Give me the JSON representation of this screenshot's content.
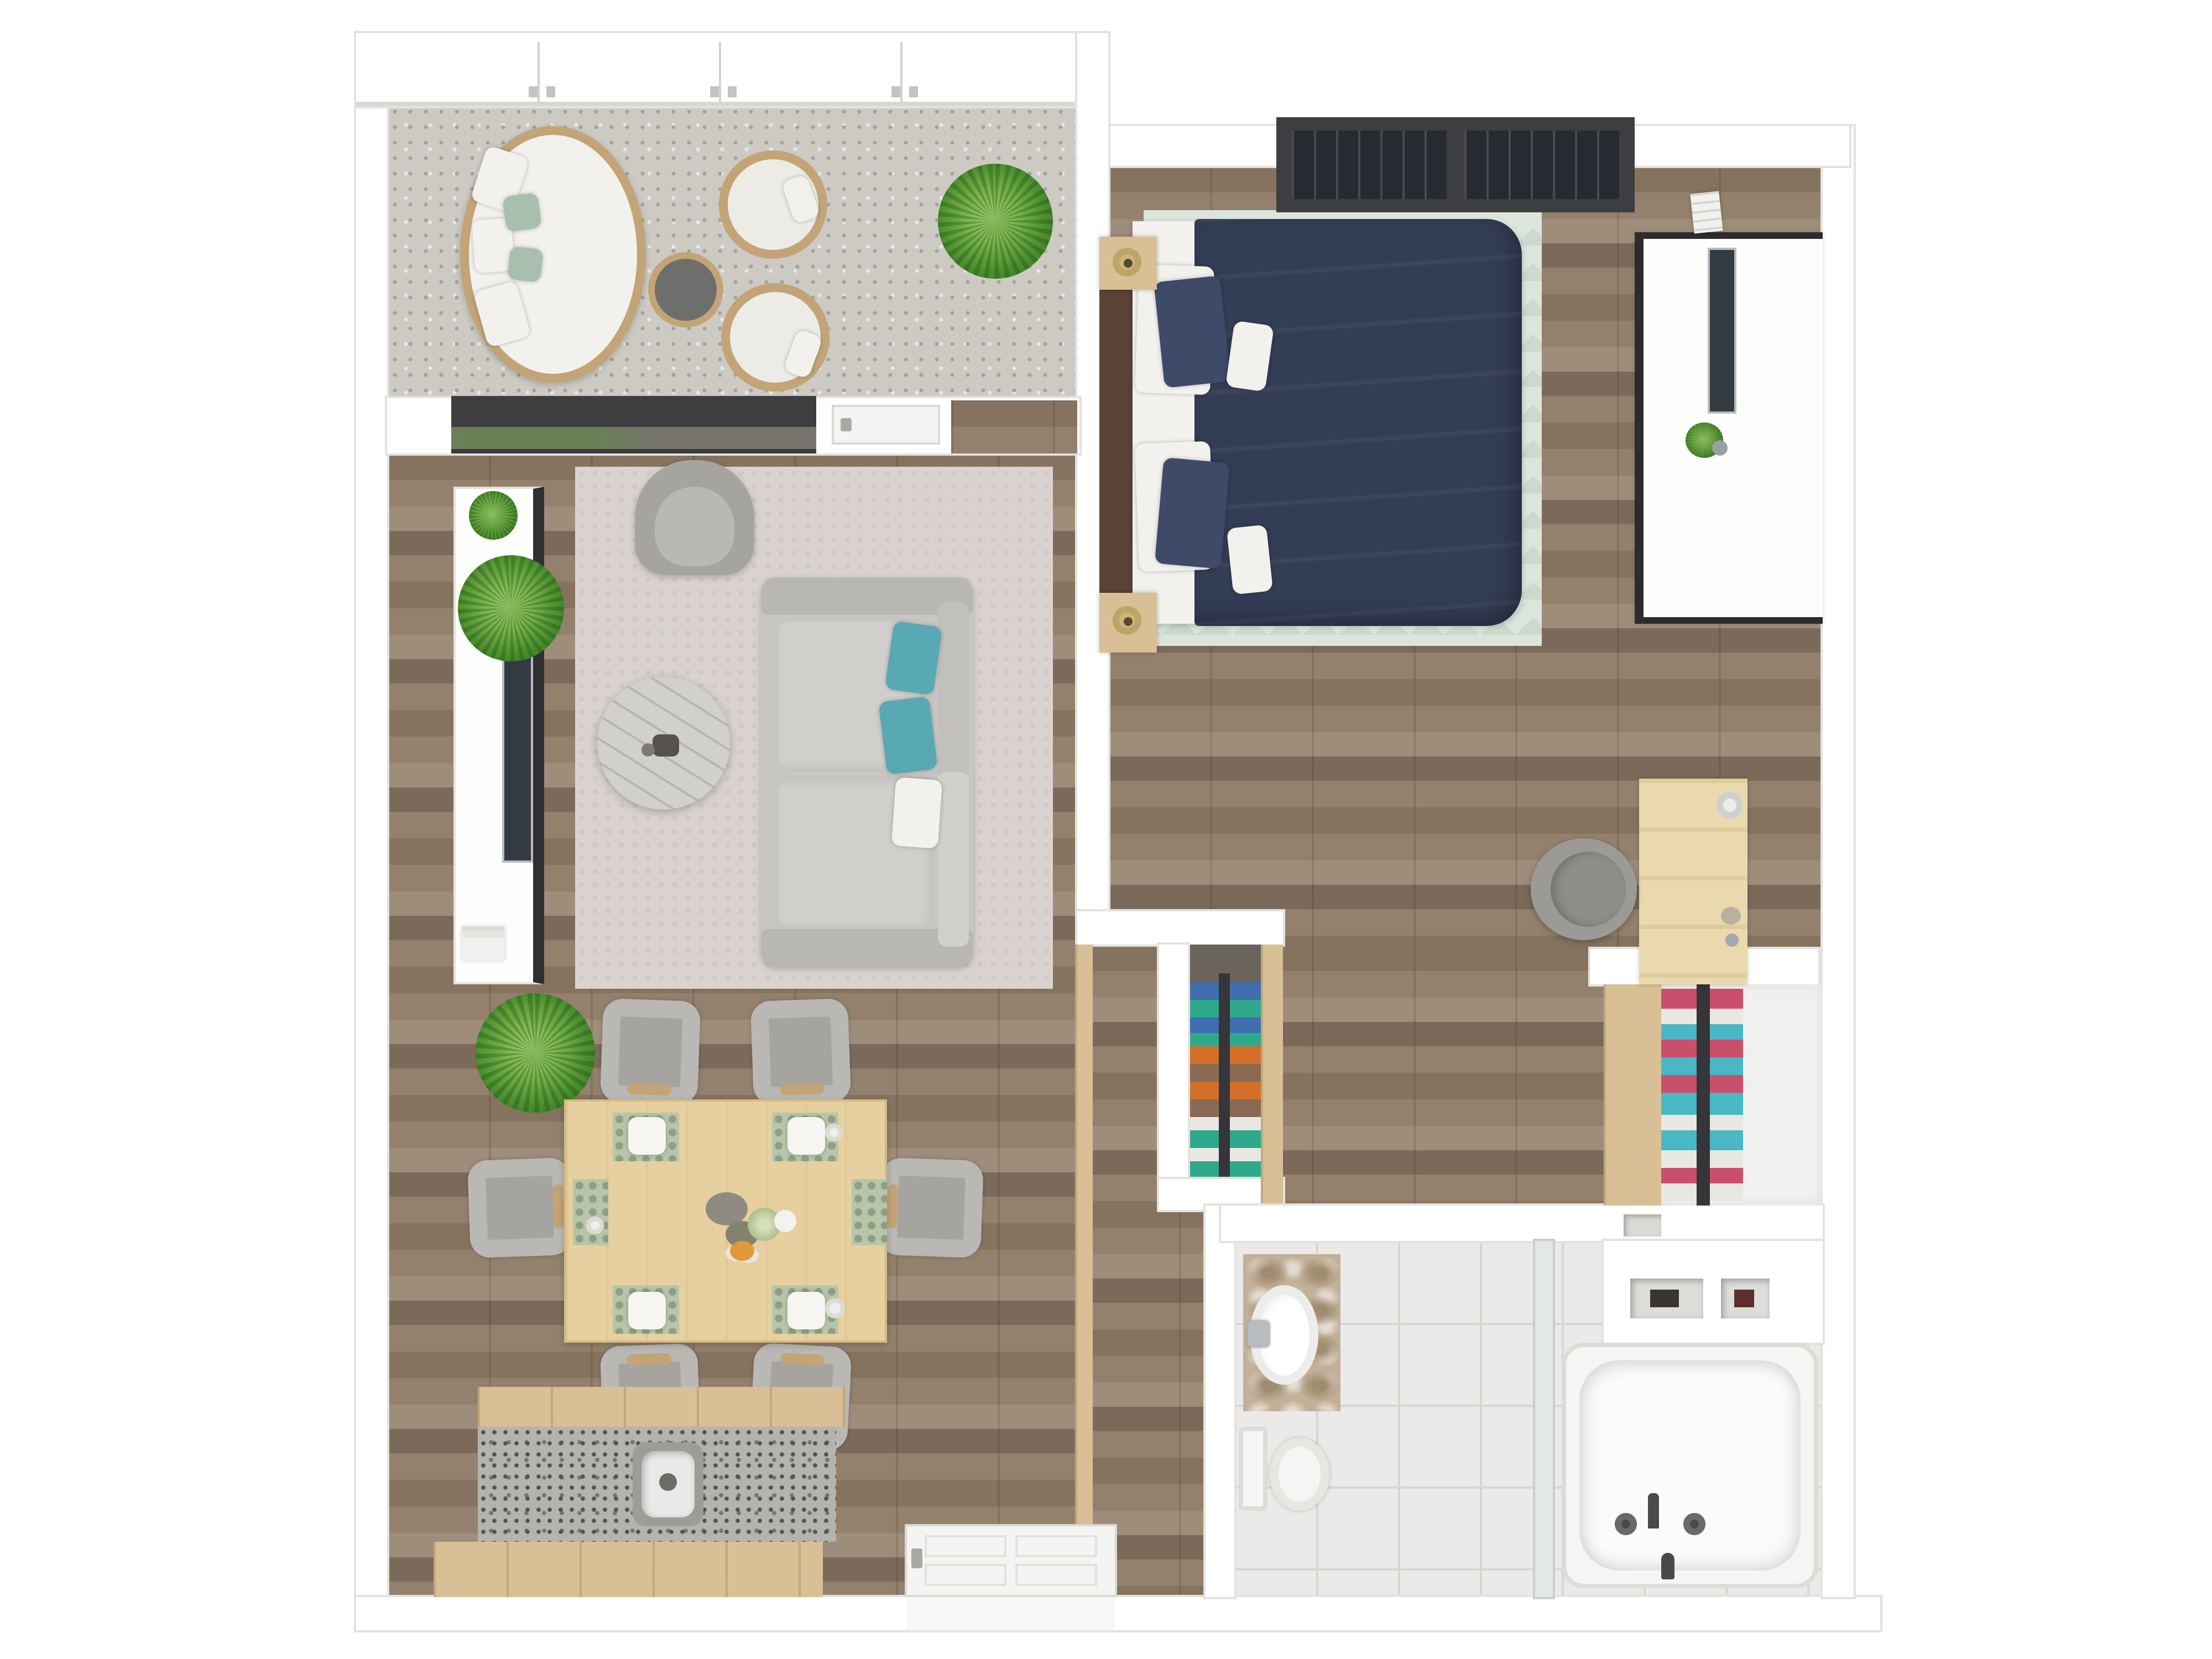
{
  "scene": {
    "type": "3d-floor-plan-top-view",
    "description": "Top-down 3D rendering of a one-bedroom apartment with balcony",
    "visible_text": []
  },
  "colors": {
    "bg": "#ffffff",
    "wall": "#ffffff",
    "wallEdge": "#e4e2df",
    "woodA": "#93816e",
    "woodB": "#85735f",
    "woodC": "#9e8d7b",
    "woodD": "#7b6a59",
    "concrete": "#cdcac4",
    "concreteDot": "#a5a199",
    "tile": "#eceae8",
    "tileLine": "#d8d6d3",
    "mint": "#dbe5dc",
    "mintAlt": "#cbdacd",
    "rugGray": "#d9d3cf",
    "navy": "#333d55",
    "navyLight": "#3d4a68",
    "soft": "#f2f1ed",
    "teal": "#58a9b3",
    "sofa": "#c8c6c3",
    "sofaDark": "#b9b7b4",
    "seat": "#d1cfcc",
    "chairGray": "#a6a4a1",
    "chairLight": "#bab8b5",
    "darkFrame": "#3e3e40",
    "tvScreen": "#343a41",
    "silver": "#b9bbbd",
    "tan": "#d8bf95",
    "tanDark": "#c2a476",
    "deskWood": "#ead9ae",
    "granite": "#b5b3ad",
    "traver": "#c2b098",
    "traverDark": "#a08c6f",
    "sage": "#a9bfae",
    "matSage": "#b7c6a9",
    "green1": "#7ab34b",
    "green2": "#2f6b1d",
    "clBlue": "#3f6fae",
    "clTeal": "#2fa98c",
    "clOrange": "#d2702a",
    "clBrown": "#8a6a52",
    "clWhite": "#e9e7e1",
    "clPink": "#c94f6d",
    "clAqua": "#49b7c4",
    "marble": "#d1d0cd",
    "fixWhite": "#f5f5f3",
    "fixEdge": "#dcdcd8",
    "glass": "#e2e6e6",
    "headboard": "#5a4335"
  },
  "rooms": [
    {
      "id": "balcony",
      "label": "Balcony",
      "floor": "concrete"
    },
    {
      "id": "living-room",
      "label": "Living room",
      "floor": "wood"
    },
    {
      "id": "dining-area",
      "label": "Dining area",
      "floor": "wood"
    },
    {
      "id": "kitchen",
      "label": "Kitchen",
      "floor": "wood"
    },
    {
      "id": "bedroom",
      "label": "Bedroom",
      "floor": "wood"
    },
    {
      "id": "hallway",
      "label": "Hallway / closets",
      "floor": "wood"
    },
    {
      "id": "entry",
      "label": "Entry",
      "floor": "wood"
    },
    {
      "id": "bathroom",
      "label": "Bathroom",
      "floor": "marble tile"
    }
  ],
  "furniture": {
    "balcony": [
      "oval rattan daybed with white cushions and 2 sage pillows",
      "round dark side table with rattan rim",
      "round wicker chair with cushion",
      "round wicker chair with cushion",
      "potted plant"
    ],
    "living_room": [
      "white media console with dark edge",
      "wall-mounted TV",
      "gray 2-cushion sofa",
      "2 teal pillows",
      "1 white pillow",
      "gray armchair",
      "round marble coffee table with decor",
      "gray area rug",
      "potted plant",
      "stack of books"
    ],
    "dining_area": [
      "light-wood 6-seat dining table",
      "6 gray upholstered chairs with wood arms",
      "6 sage patterned placemats",
      "4 white square plates",
      "3 cups",
      "stone vase centerpiece",
      "small plant",
      "fruit bowl",
      "potted plant"
    ],
    "kitchen": [
      "wood cabinet run",
      "granite countertop",
      "sink with faucet",
      "wood island unit"
    ],
    "bedroom": [
      "double bed with navy duvet",
      "2 white pillows",
      "2 navy pillows",
      "2 white accent cushions",
      "dark wood headboard",
      "2 nightstands with lamps",
      "mint geometric rug",
      "double window with dark frame",
      "white media unit with dark frame",
      "wall-mounted TV",
      "AC vent",
      "light-wood desk with lamp",
      "gray desk chair",
      "small plant"
    ],
    "closets": [
      "hanging rack: blue/teal/orange/brown/white clothes",
      "wood wardrobe panel",
      "hanging rack: pink/white/aqua clothes",
      "wood wardrobe panel",
      "storage niches"
    ],
    "bathroom": [
      "travertine vanity with round white sink",
      "chrome faucet",
      "toilet",
      "glass shower screen",
      "built-in shelf with niches",
      "bathtub with black spout, two cross handles and hand shower"
    ],
    "entry": [
      "white paneled entry door shown open",
      "light-wood wall panel"
    ]
  },
  "clothes_racks": {
    "middle_closet_colors": [
      "blue",
      "teal",
      "blue",
      "teal",
      "orange",
      "brown",
      "orange",
      "brown",
      "white",
      "teal",
      "white",
      "teal"
    ],
    "right_closet_colors": [
      "pink",
      "white",
      "aqua",
      "pink",
      "aqua",
      "pink",
      "aqua",
      "white",
      "aqua",
      "white",
      "pink",
      "white"
    ]
  },
  "openings": {
    "balcony_glazing_panes": 4,
    "balcony_sliding_door": 1,
    "balcony_swing_door": 1,
    "bedroom_windows": 2,
    "entry_door": 1
  }
}
